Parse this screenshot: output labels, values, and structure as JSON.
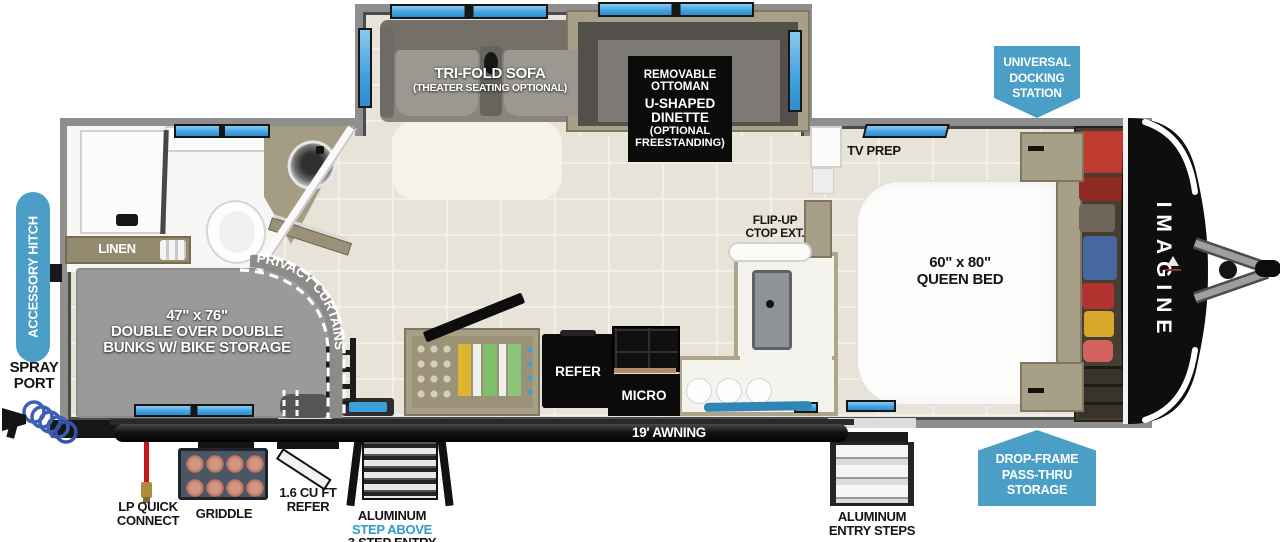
{
  "badges": {
    "universal_docking_station": "UNIVERSAL DOCKING STATION",
    "accessory_hitch": "ACCESSORY HITCH",
    "drop_frame_storage": "DROP-FRAME PASS-THRU STORAGE"
  },
  "exterior": {
    "spray_port": "SPRAY PORT",
    "awning": "19' AWNING",
    "lp_quick_connect": "LP QUICK CONNECT",
    "griddle": "GRIDDLE",
    "compact_refer_line1": "1.6 CU FT",
    "compact_refer_line2": "REFER",
    "entry_left_line1": "ALUMINUM",
    "entry_left_line2": "STEP ABOVE",
    "entry_left_line3": "3 STEP ENTRY",
    "entry_right_line1": "ALUMINUM",
    "entry_right_line2": "ENTRY STEPS",
    "brand_logo": "IMAGINE"
  },
  "living": {
    "sofa": "TRI-FOLD SOFA",
    "sofa_option": "(THEATER SEATING OPTIONAL)",
    "dinette_line1": "REMOVABLE OTTOMAN",
    "dinette_line2": "U-SHAPED DINETTE",
    "dinette_line3": "(OPTIONAL FREESTANDING)",
    "tv_prep": "TV PREP"
  },
  "kitchen": {
    "refer": "REFER",
    "micro": "MICRO",
    "flip_up_line1": "FLIP-UP",
    "flip_up_line2": "CTOP EXT."
  },
  "bedroom": {
    "bed_size": "60\" x 80\"",
    "bed_label": "QUEEN BED"
  },
  "bunkroom": {
    "bunks_size": "47\" x 76\"",
    "bunks_line2": "DOUBLE OVER DOUBLE",
    "bunks_line3": "BUNKS W/ BIKE STORAGE",
    "privacy_curtains": "PRIVACY CURTAINS",
    "linen": "LINEN"
  },
  "colors": {
    "badge_blue": "#4b9fc7",
    "accent_blue_text": "#2e9bc8",
    "window_blue": "#3da2e2",
    "wall_gray": "#8f8f8f",
    "bunk_gray": "#9a9a9a",
    "counter_tan": "#a89f88",
    "cap_black": "#0e0e0e"
  }
}
